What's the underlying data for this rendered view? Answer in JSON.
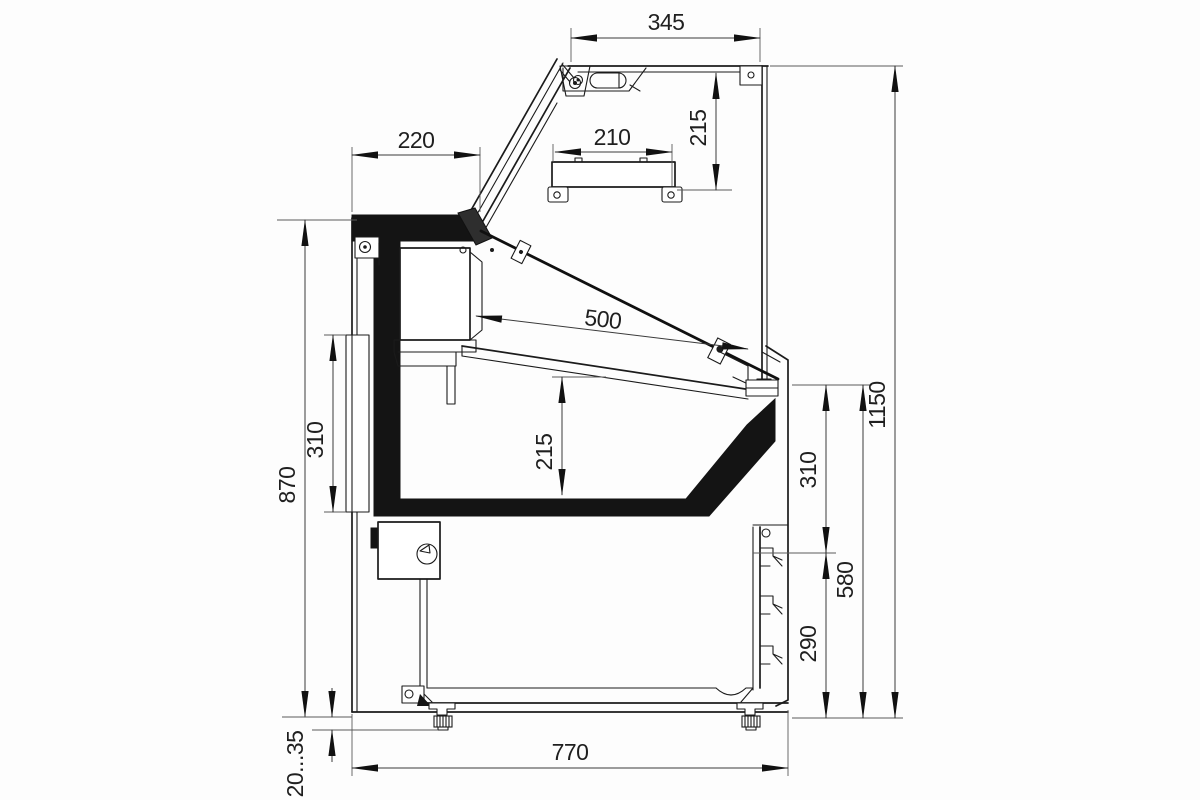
{
  "drawing": {
    "type": "technical-section-drawing",
    "subject": "serve-over refrigerated display counter, side cross-section with dimensions (mm)",
    "units": "mm",
    "colors": {
      "line": "#1b1b1b",
      "dimension_line": "#3a3a3a",
      "text": "#1f1f1f",
      "insulation_fill": "#141414",
      "background": "#fdfdfd"
    }
  },
  "dimensions": {
    "top": {
      "canopy_width": "345",
      "canopy_to_shelf": "215",
      "shelf_width": "210",
      "worktop_depth": "220"
    },
    "middle": {
      "display_deck_length": "500",
      "deck_clearance": "215"
    },
    "left": {
      "body_height": "870",
      "rear_opening_height": "310"
    },
    "right": {
      "glass_zone_height": "310",
      "front_height": "580",
      "louver_zone_height": "290",
      "overall_height": "1150"
    },
    "bottom": {
      "base_depth": "770",
      "leg_adjust_range": "20...35"
    }
  }
}
